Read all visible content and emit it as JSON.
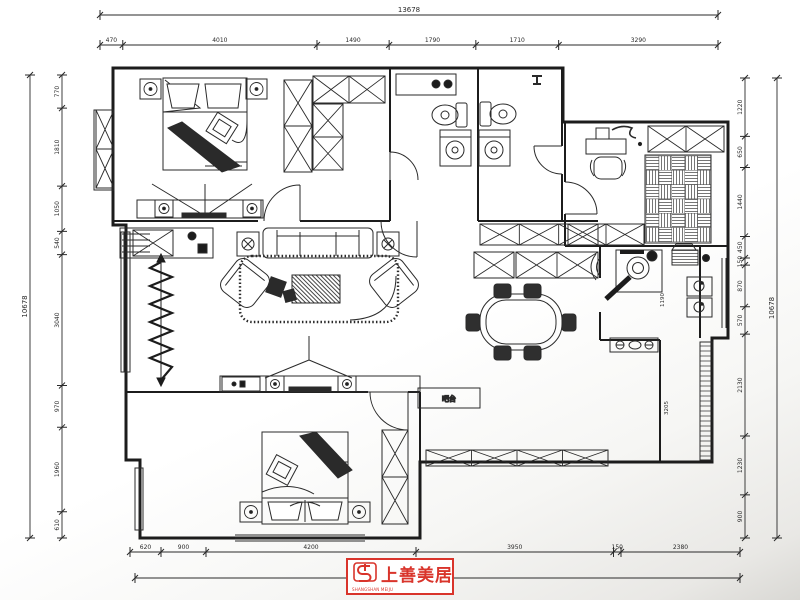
{
  "dimensions": {
    "top_total": "13678",
    "top": [
      "470",
      "4010",
      "1490",
      "1790",
      "1710",
      "3290"
    ],
    "bottom": [
      "620",
      "900",
      "4200",
      "3950",
      "150",
      "2380"
    ],
    "bottom_total": "13678",
    "left_total": "10678",
    "left": [
      "770",
      "1810",
      "1050",
      "540",
      "3040",
      "970",
      "1960",
      "610"
    ],
    "right_total": "10678",
    "right": [
      "1220",
      "650",
      "1440",
      "450",
      "150",
      "870",
      "570",
      "2130",
      "1230",
      "900"
    ],
    "inner": {
      "kitchen_width": "1190",
      "balcony_height": "3205"
    }
  },
  "labels": {
    "bar_counter": "吧台"
  },
  "logo": {
    "name": "上善美居",
    "tagline": "SHANGSHAN MEIJU",
    "color": "#d9342b"
  },
  "colors": {
    "line": "#1c1c1c",
    "accent_red": "#d9342b"
  }
}
